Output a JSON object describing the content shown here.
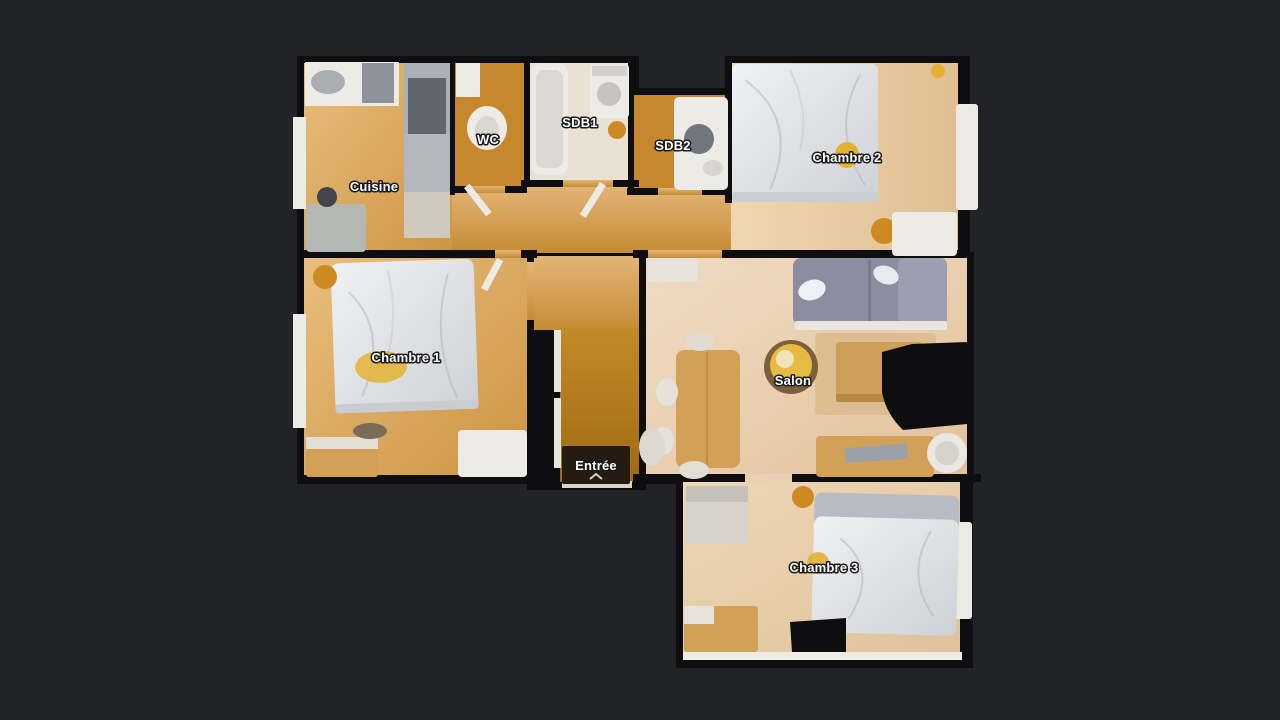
{
  "viewer": {
    "mode": "floor-plan-top-view",
    "description": "3D scanned apartment floor plan on dark background"
  },
  "rooms": [
    {
      "id": "cuisine",
      "label": "Cuisine"
    },
    {
      "id": "wc",
      "label": "WC"
    },
    {
      "id": "sdb1",
      "label": "SDB1"
    },
    {
      "id": "sdb2",
      "label": "SDB2"
    },
    {
      "id": "chambre2",
      "label": "Chambre 2"
    },
    {
      "id": "chambre1",
      "label": "Chambre 1"
    },
    {
      "id": "salon",
      "label": "Salon"
    },
    {
      "id": "entree",
      "label": "Entrée"
    },
    {
      "id": "chambre3",
      "label": "Chambre 3"
    }
  ],
  "colors": {
    "background": "#212326",
    "wall": "#0e0e11",
    "floor_honey": "#d9a156",
    "floor_amber": "#c6872d",
    "floor_pale": "#e9e2d4",
    "floor_salon": "#e9d2b4",
    "floor_entry": "#b37817",
    "fixture_white": "#edebe5",
    "appliance_gray": "#aab0b6",
    "bed_white": "#e6e7e9",
    "bed_gray": "#b7bbc3",
    "sofa": "#8b8da0",
    "wood_furniture": "#d2a157",
    "rug": "#ddbd91",
    "mat_dark": "#261b10",
    "accent_orange": "#cd8a22",
    "accent_yellow": "#e4b133",
    "label_text": "#ffffff"
  }
}
